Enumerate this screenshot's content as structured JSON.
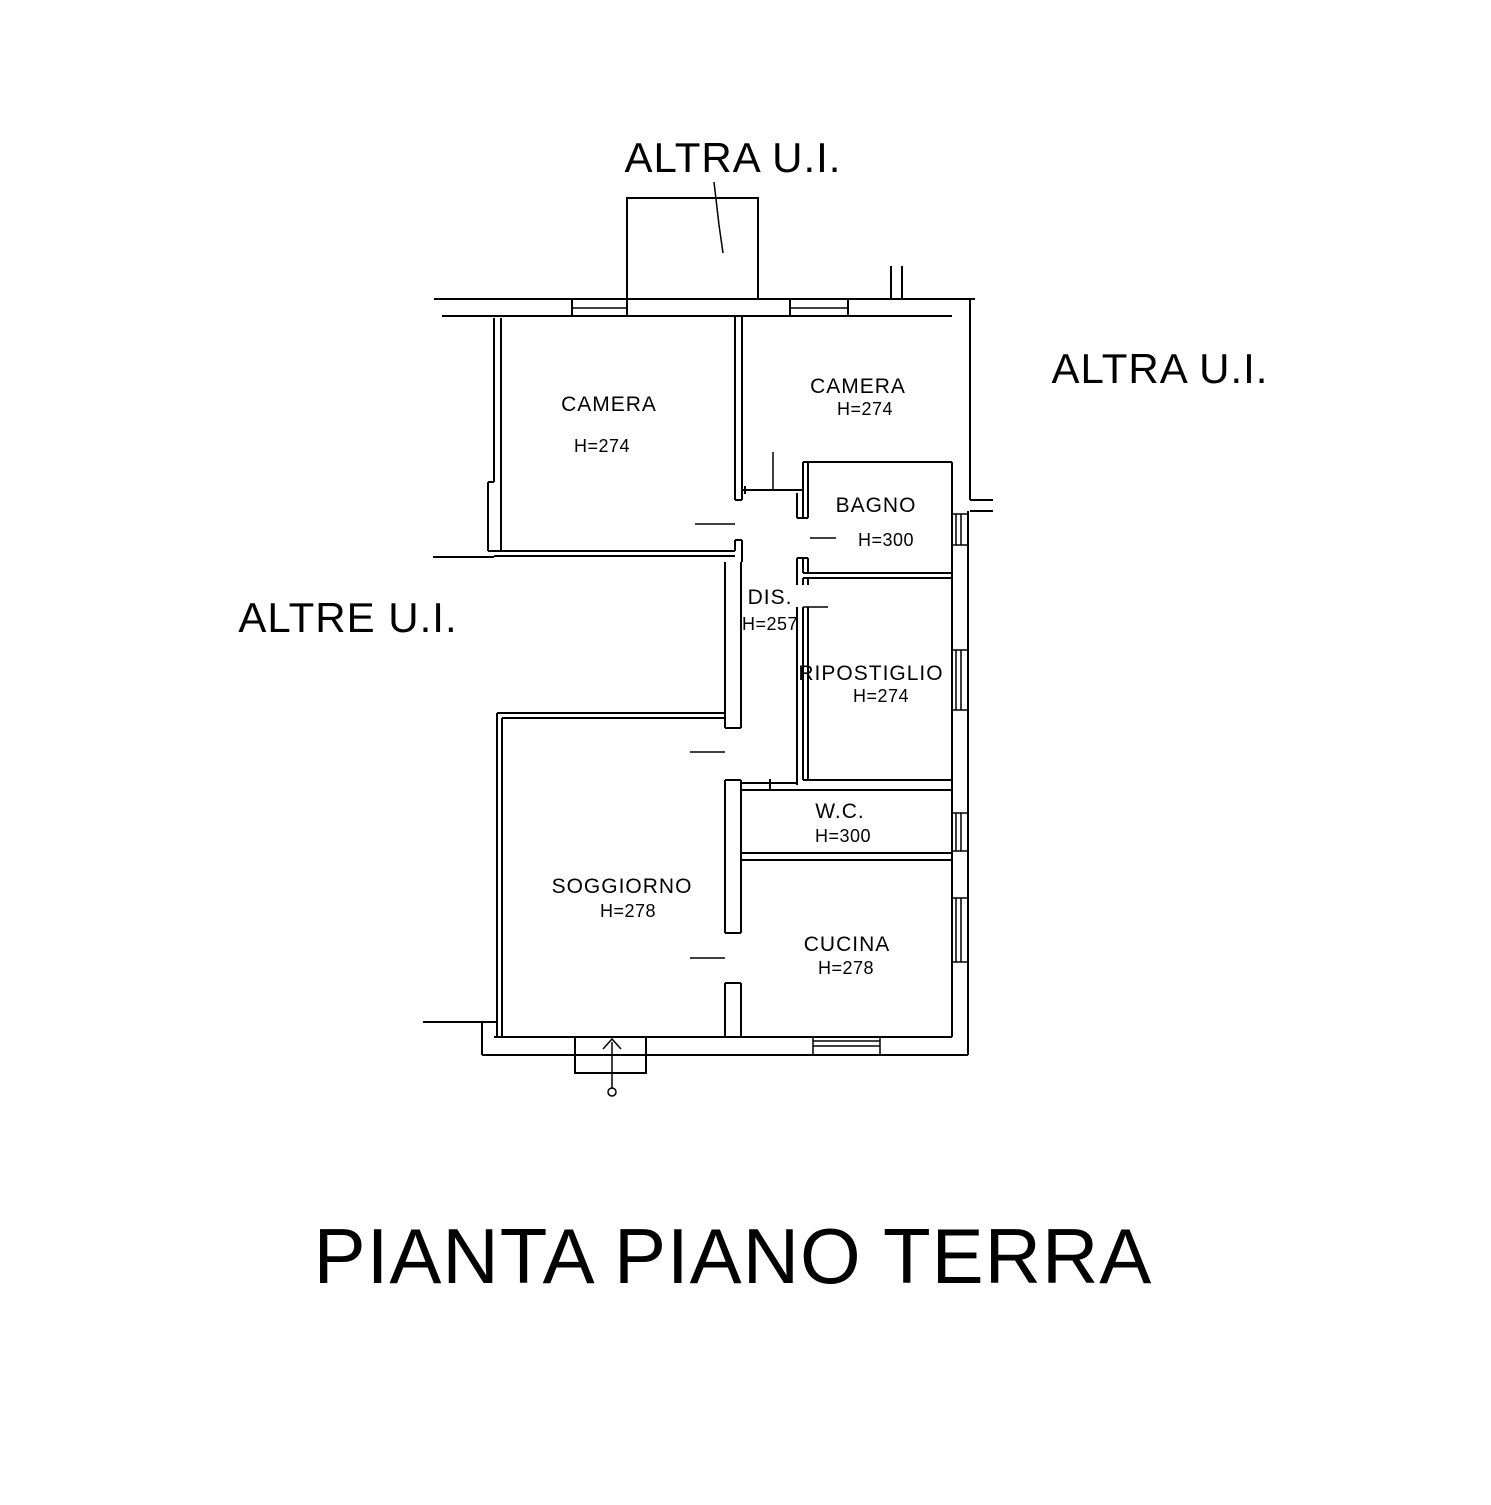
{
  "drawing": {
    "title": "PIANTA PIANO TERRA",
    "annotations": {
      "top": "ALTRA U.I.",
      "right": "ALTRA U.I.",
      "left": "ALTRE U.I."
    },
    "rooms": [
      {
        "id": "camera-1",
        "name": "CAMERA",
        "height": "H=274"
      },
      {
        "id": "camera-2",
        "name": "CAMERA",
        "height": "H=274"
      },
      {
        "id": "bagno",
        "name": "BAGNO",
        "height": "H=300"
      },
      {
        "id": "dis",
        "name": "DIS.",
        "height": "H=257"
      },
      {
        "id": "ripostiglio",
        "name": "RIPOSTIGLIO",
        "height": "H=274"
      },
      {
        "id": "wc",
        "name": "W.C.",
        "height": "H=300"
      },
      {
        "id": "soggiorno",
        "name": "SOGGIORNO",
        "height": "H=278"
      },
      {
        "id": "cucina",
        "name": "CUCINA",
        "height": "H=278"
      }
    ],
    "colors": {
      "line": "#000000",
      "background": "#ffffff"
    }
  }
}
